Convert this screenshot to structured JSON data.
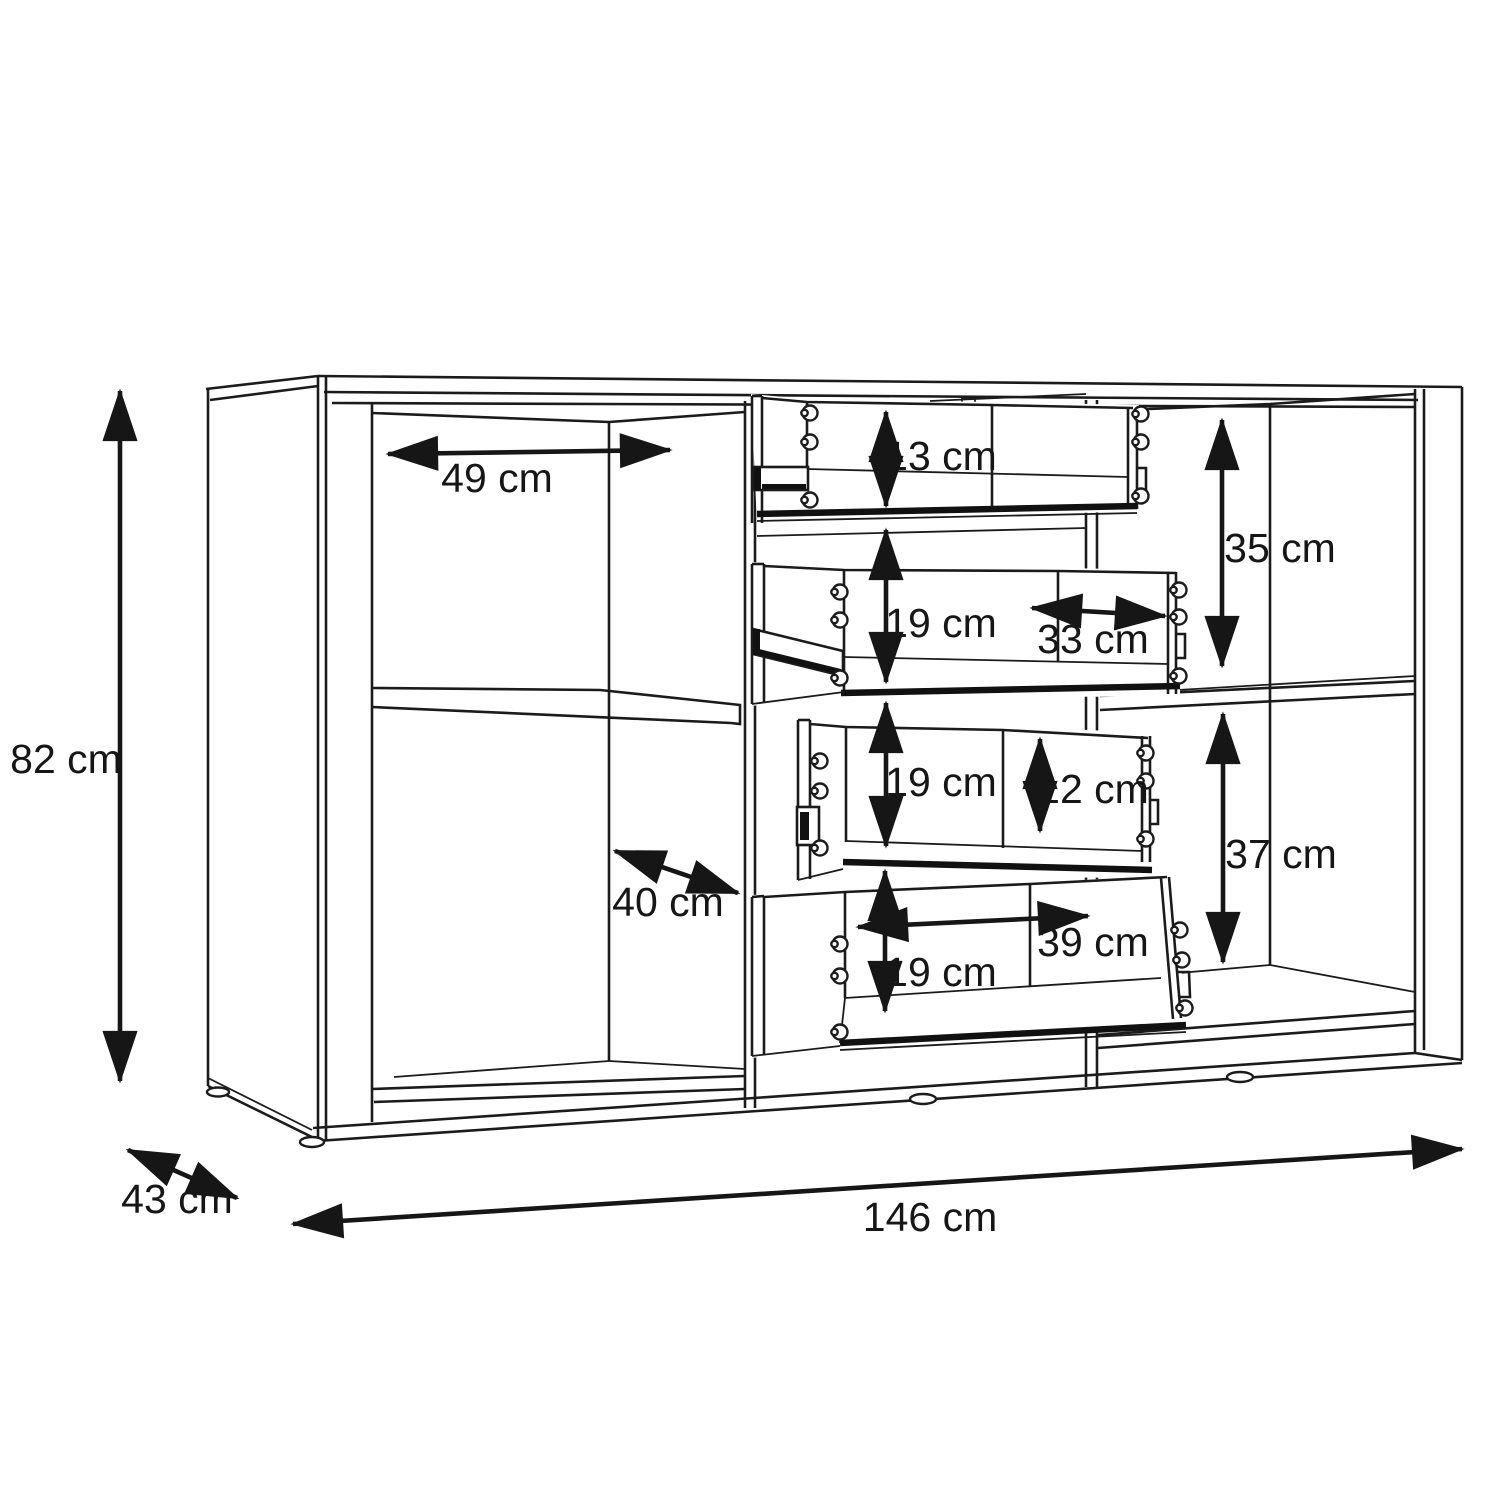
{
  "figure": {
    "kind": "furniture-dimension-diagram",
    "subject": "sideboard line drawing with two shelved side compartments and four pulled-out drawers",
    "unit": "cm",
    "line_color": "#1b1b1b",
    "background_color": "#ffffff"
  },
  "dims": {
    "overall_height": "82 cm",
    "overall_depth": "43 cm",
    "overall_width": "146 cm",
    "left_compartment_width": "49 cm",
    "left_compartment_depth": "40 cm",
    "drawer1_height": "13 cm",
    "drawer2_height": "19 cm",
    "drawer2_inner_width": "33 cm",
    "drawer3_height": "19 cm",
    "drawer3_inner_height": "12 cm",
    "drawer4_height": "19 cm",
    "drawer4_inner_width": "39 cm",
    "right_upper_compartment_height": "35 cm",
    "right_lower_compartment_height": "37 cm"
  },
  "icons": {
    "cam_lock_screw": "double-circle screw head",
    "arrowhead": "solid triangle dimension arrowhead"
  }
}
